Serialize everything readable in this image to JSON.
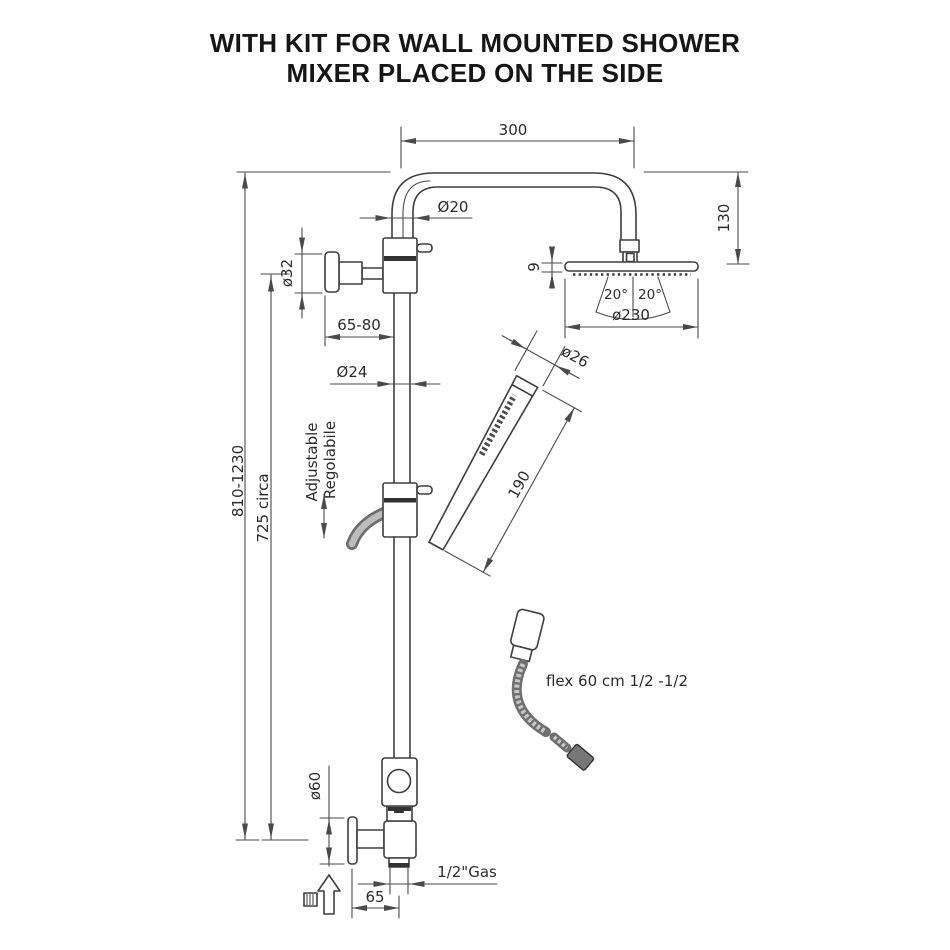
{
  "title": {
    "line1": "WITH KIT FOR WALL MOUNTED SHOWER",
    "line2": "MIXER PLACED ON THE SIDE"
  },
  "drawing": {
    "dims": {
      "arm_length": "300",
      "arm_pipe_dia": "Ø20",
      "head_drop": "130",
      "head_thickness": "9",
      "spray_angle_left": "20°",
      "spray_angle_right": "20°",
      "head_dia": "ø230",
      "bracket_dia": "ø32",
      "bracket_reach": "65-80",
      "column_dia": "Ø24",
      "handshower_dia": "ø26",
      "handshower_len": "190",
      "column_height_range": "810-1230",
      "column_height_fixed": "725 circa",
      "flange_dia": "ø60",
      "outlet_thread": "1/2\"Gas",
      "outlet_offset": "65"
    },
    "labels": {
      "adjustable_en": "Adjustable",
      "adjustable_it": "Regolabile",
      "flex_hose": "flex  60  cm  1/2  -1/2"
    },
    "colors": {
      "object_line": "#3e3e3e",
      "dimension_line": "#4a4a4a",
      "text": "#2b2b2b",
      "hose_fill": "#bdbdbd"
    }
  }
}
